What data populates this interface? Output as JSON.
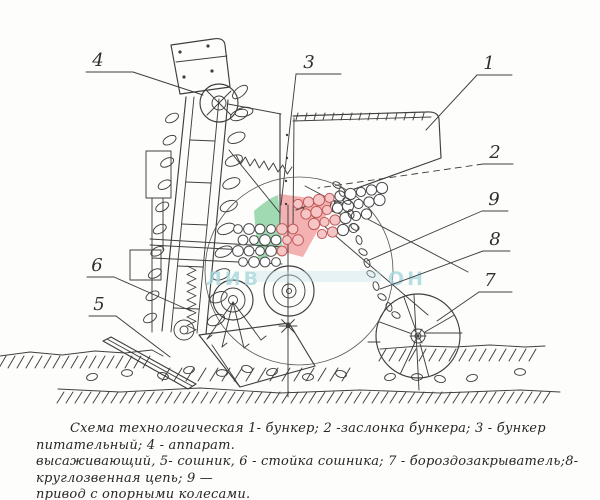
{
  "figure": {
    "caption": {
      "line1": "Схема технологическая  1- бункер; 2 -заслонка бункера; 3 - бункер питательный; 4 - аппарат.",
      "line2": "высаживающий, 5- сошник, 6 - стойка сошника; 7 - бороздозакрыватель;8-круглозвенная цепь;  9 —",
      "line3": "привод с опорными колесами."
    },
    "labels": [
      {
        "number": "1",
        "part": "бункер"
      },
      {
        "number": "2",
        "part": "заслонка бункера"
      },
      {
        "number": "3",
        "part": "бункер питательный"
      },
      {
        "number": "4",
        "part": "аппарат высаживающий"
      },
      {
        "number": "5",
        "part": "сошник"
      },
      {
        "number": "6",
        "part": "стойка сошника"
      },
      {
        "number": "7",
        "part": "бороздозакрыватель"
      },
      {
        "number": "8",
        "part": "круглозвенная цепь"
      },
      {
        "number": "9",
        "part": "привод с опорными колесами"
      }
    ],
    "watermark": {
      "text_left": "ЛИВ",
      "text_right": "ОН",
      "color_green": "#8ed3a4",
      "color_pink": "#f2a3a3",
      "color_blue": "#a6d7de"
    },
    "colors": {
      "ink": "#3f3f3f",
      "paper": "#fdfdfc"
    }
  }
}
